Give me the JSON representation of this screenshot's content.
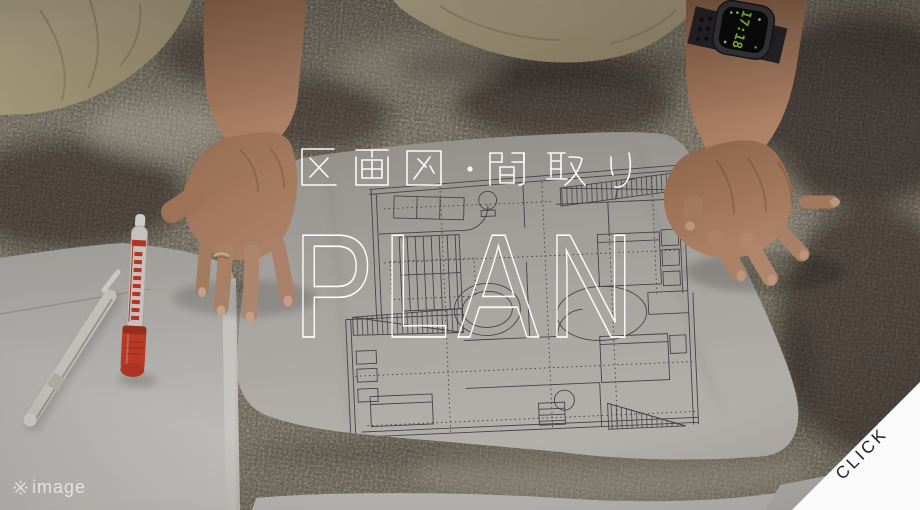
{
  "banner": {
    "subtitle": "区画図・間取り",
    "title": "PLAN",
    "image_note_mark": "※",
    "image_note_text": "image",
    "cta_label": "CLICK"
  },
  "photo": {
    "smartwatch_time": "17:18"
  },
  "colors": {
    "overlay_text": "#ffffff",
    "cta_background": "#fafafa",
    "cta_text": "#1e1e1e",
    "marker_red": "#cf3f2b",
    "watch_time_green": "#9fdb3e",
    "carpet_base": "#87816f"
  }
}
